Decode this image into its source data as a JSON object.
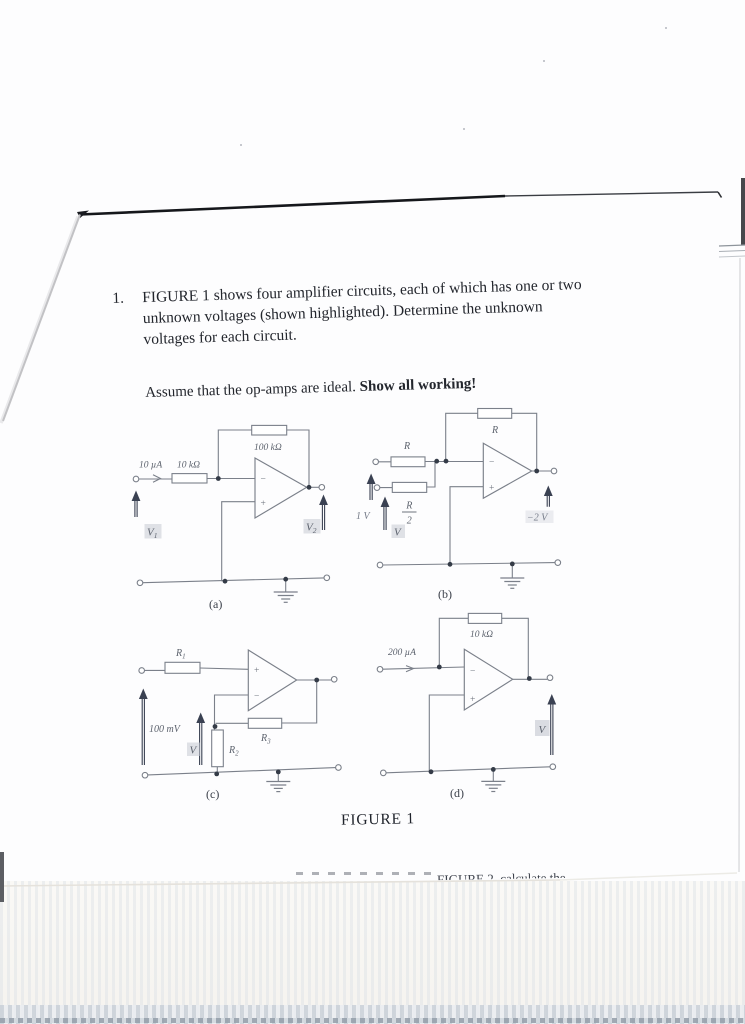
{
  "colors": {
    "highlight": "#c7cbd2",
    "ink": "#23262d",
    "schematic": "#7b808a",
    "arrow": "#3a4152"
  },
  "problem": {
    "number": "1.",
    "line1": "FIGURE 1 shows four amplifier circuits, each of which has one or two",
    "line2": "unknown voltages (shown highlighted). Determine the unknown",
    "line3": "voltages for each circuit.",
    "assume": "Assume that the op-amps are ideal. ",
    "assume_bold": "Show all working!"
  },
  "caption": "FIGURE 1",
  "cutoff_fragment": "FIGURE 2, calculate the",
  "opamp": {
    "minus": "−",
    "plus": "+"
  },
  "circuits": {
    "a": {
      "tag": "(a)",
      "current": "10 µA",
      "r_in": "10 kΩ",
      "r_fb": "100 kΩ",
      "v1_base": "V",
      "v1_sub": "1",
      "v2_base": "V",
      "v2_sub": "2"
    },
    "b": {
      "tag": "(b)",
      "r_in": "R",
      "r_fb": "R",
      "frac_num": "R",
      "frac_den": "2",
      "v_outer": "1 V",
      "v_inner": "V",
      "v_out": "−2 V"
    },
    "c": {
      "tag": "(c)",
      "r1_base": "R",
      "r1_sub": "1",
      "r2_base": "R",
      "r2_sub": "2",
      "r3_base": "R",
      "r3_sub": "3",
      "v_in": "100 mV",
      "v_node": "V"
    },
    "d": {
      "tag": "(d)",
      "current": "200 µA",
      "r_fb": "10 kΩ",
      "v_out": "V"
    }
  }
}
